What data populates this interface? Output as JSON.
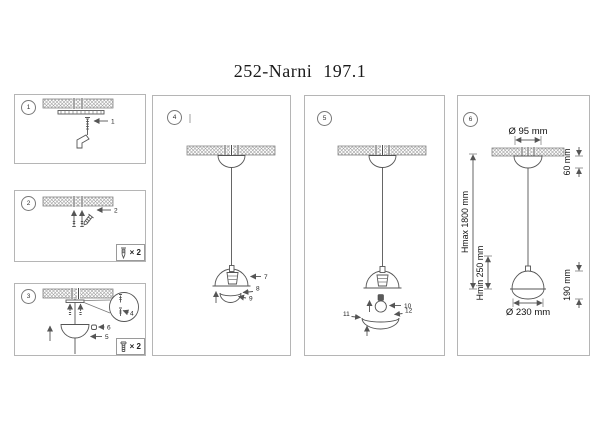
{
  "title": "252-Narni 197.1",
  "steps": {
    "s1": "1",
    "s2": "2",
    "s3": "3",
    "s4": "4",
    "s5": "5",
    "s6": "6"
  },
  "part_labels": {
    "p1": "1",
    "p2": "2",
    "p3": "3",
    "p4": "4",
    "p5": "5",
    "p6": "6",
    "p7": "7",
    "p8": "8",
    "p9": "9",
    "p10": "10",
    "p11": "11",
    "p12": "12"
  },
  "quantities": {
    "wood_screws": "× 2",
    "machine_screws": "× 2"
  },
  "dimensions": {
    "canopy_diameter": "Ø 95 mm",
    "canopy_height": "60 mm",
    "height_max": "Hmax 1800 mm",
    "height_min": "Hmin 250 mm",
    "shade_height": "190 mm",
    "shade_diameter": "Ø 230 mm"
  },
  "icons": {
    "wood_screw": "wood-screw-icon",
    "machine_screw": "machine-screw-icon",
    "wall_plug": "wall-plug-icon",
    "magnifier": "detail-magnifier-circle"
  },
  "colors": {
    "line": "#555555",
    "hatch": "#9e9e9e",
    "panel_border": "#b5b5b5",
    "text": "#1b1b1b"
  }
}
